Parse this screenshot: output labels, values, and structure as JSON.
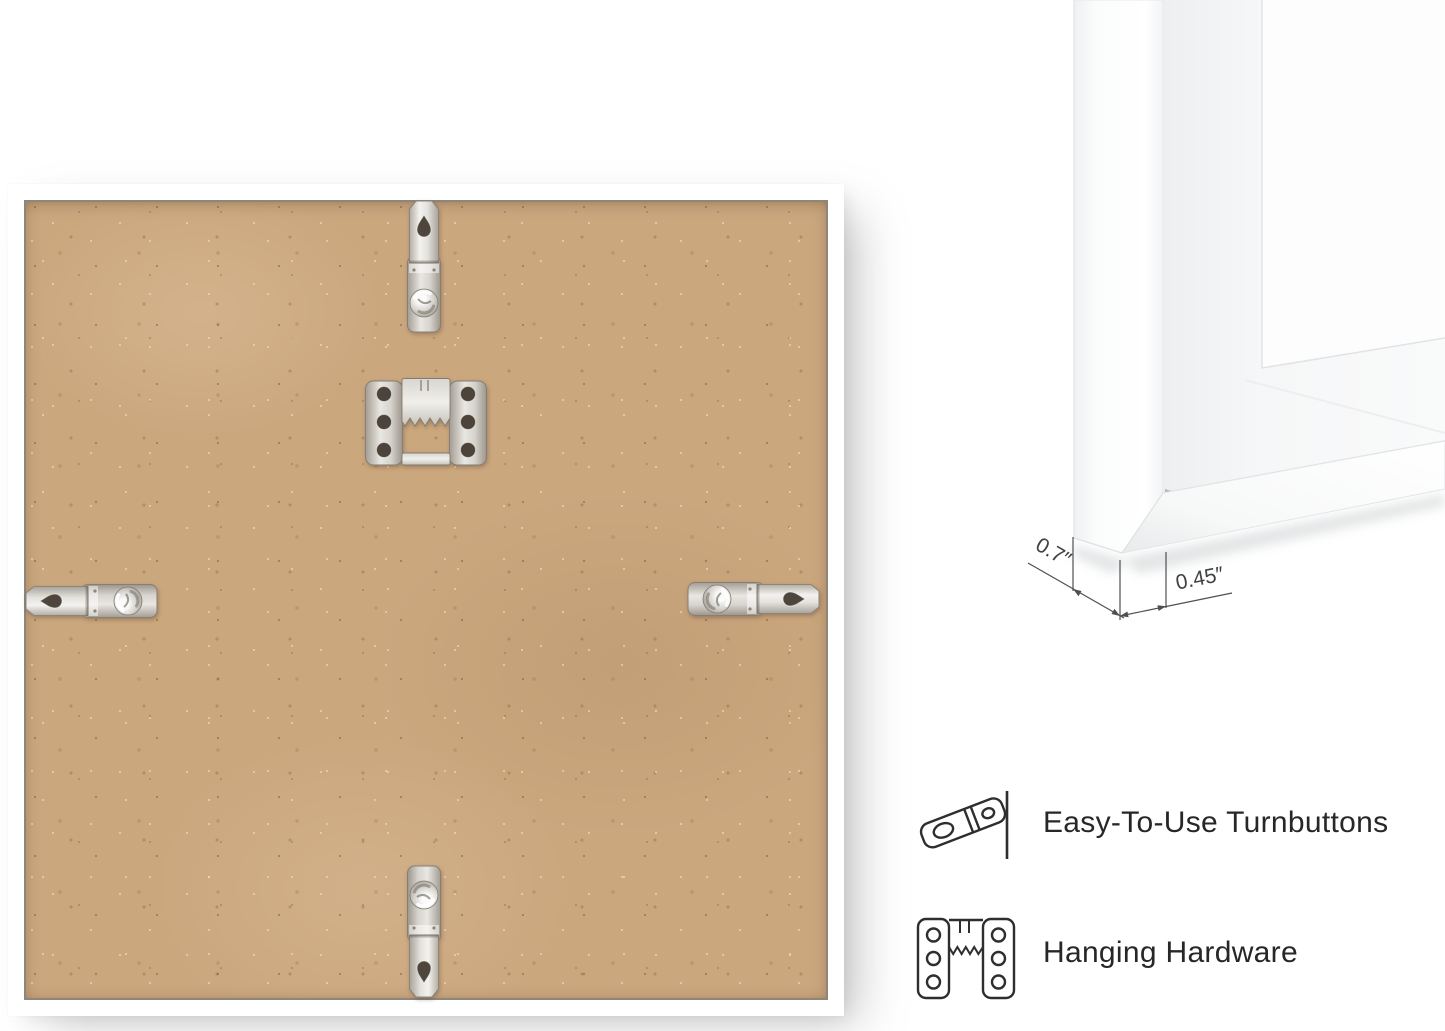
{
  "corner_detail": {
    "depth_label": "0.7″",
    "face_width_label": "0.45″"
  },
  "features": [
    {
      "icon": "turnbutton-icon",
      "label": "Easy-To-Use Turnbuttons"
    },
    {
      "icon": "sawtooth-hanger-icon",
      "label": "Hanging Hardware"
    }
  ],
  "colors": {
    "background": "#ffffff",
    "frame_white": "#ffffff",
    "mdf_board": "#cba77e",
    "metal_silver": "#d9d6d1",
    "outline_dark": "#2e2e2e",
    "dimension_text": "#3e4244"
  }
}
